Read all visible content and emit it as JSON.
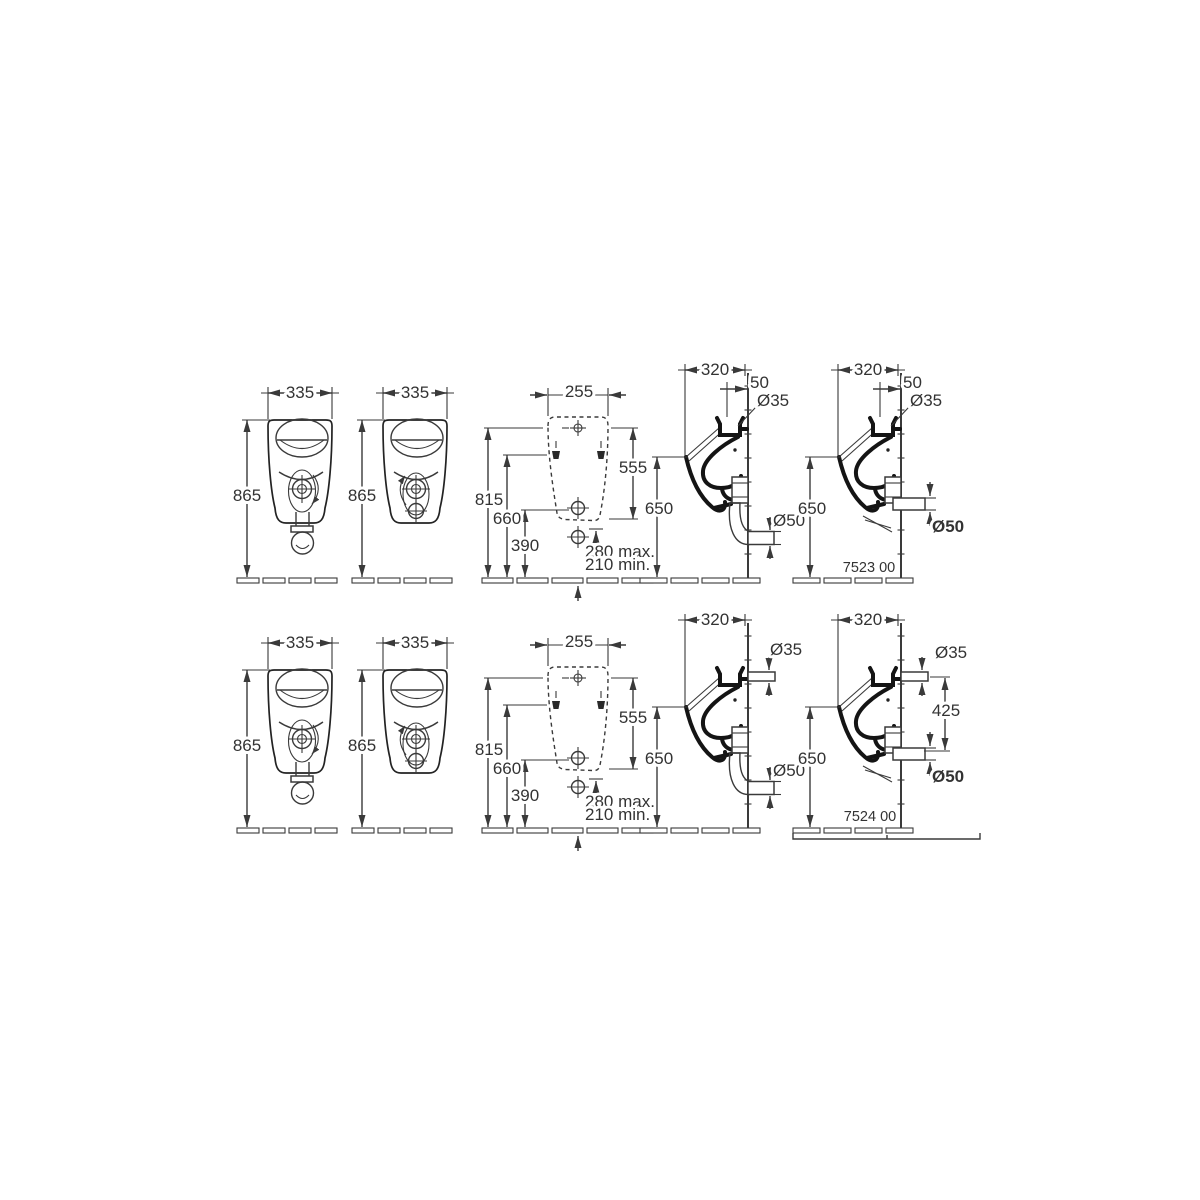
{
  "colors": {
    "line": "#3a3a3a",
    "profile": "#141414",
    "background": "#ffffff"
  },
  "drawing": {
    "rows": [
      {
        "front_a": {
          "width": "335",
          "height": "865"
        },
        "front_b": {
          "width": "335",
          "height": "865"
        },
        "mounting": {
          "width": "255",
          "inlet_height": "815",
          "fixing_height": "660",
          "outlet_height": "390",
          "inlet_to_outlet": "555",
          "outlet_max": "280 max.",
          "outlet_min": "210 min."
        },
        "side_a": {
          "depth": "320",
          "inlet_offset": "50",
          "inlet_dia": "Ø35",
          "rim_height": "650",
          "drain_dia": "Ø50"
        },
        "side_b": {
          "depth": "320",
          "inlet_offset": "50",
          "inlet_dia": "Ø35",
          "rim_height": "650",
          "drain_dia": "Ø50",
          "model": "7523 00"
        }
      },
      {
        "front_a": {
          "width": "335",
          "height": "865"
        },
        "front_b": {
          "width": "335",
          "height": "865"
        },
        "mounting": {
          "width": "255",
          "inlet_height": "815",
          "fixing_height": "660",
          "outlet_height": "390",
          "inlet_to_outlet": "555",
          "outlet_max": "280 max.",
          "outlet_min": "210 min."
        },
        "side_a": {
          "depth": "320",
          "inlet_dia": "Ø35",
          "rim_height": "650",
          "drain_dia": "Ø50"
        },
        "side_b": {
          "depth": "320",
          "inlet_dia": "Ø35",
          "inlet_to_drain": "425",
          "rim_height": "650",
          "drain_dia": "Ø50",
          "model": "7524 00"
        }
      }
    ]
  }
}
